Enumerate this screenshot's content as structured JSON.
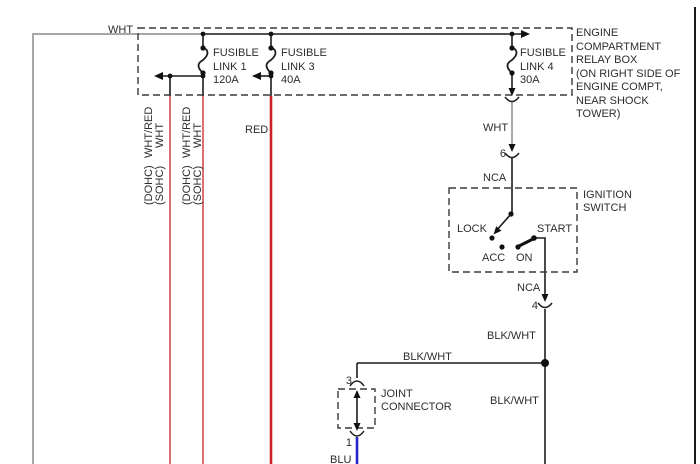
{
  "colors": {
    "wire_wht": "#a8a8a8",
    "wire_red_thin": "#cc3434",
    "wire_red_thick": "#cc2222",
    "wire_blu": "#2424cc",
    "wire_blk": "#1c1c1c",
    "text": "#2d2d2d"
  },
  "relay_box": {
    "label_lines": [
      "ENGINE",
      "COMPARTMENT",
      "RELAY BOX",
      "(ON RIGHT SIDE OF",
      "ENGINE COMPT,",
      "NEAR SHOCK",
      "TOWER)"
    ]
  },
  "fusible_links": [
    {
      "l1": "FUSIBLE",
      "l2": "LINK 1",
      "l3": "120A"
    },
    {
      "l1": "FUSIBLE",
      "l2": "LINK 3",
      "l3": "40A"
    },
    {
      "l1": "FUSIBLE",
      "l2": "LINK 4",
      "l3": "30A"
    }
  ],
  "branch_wires": [
    {
      "color_dohc": "WHT/RED",
      "color_sohc": "WHT",
      "engine_top": "(DOHC)",
      "engine_bottom": "(SOHC)"
    },
    {
      "color_dohc": "WHT/RED",
      "color_sohc": "WHT",
      "engine_top": "(DOHC)",
      "engine_bottom": "(SOHC)"
    }
  ],
  "ignition_switch": {
    "title_lines": [
      "IGNITION",
      "SWITCH"
    ],
    "positions": {
      "lock": "LOCK",
      "acc": "ACC",
      "on": "ON",
      "start": "START"
    }
  },
  "joint_connector": {
    "label_lines": [
      "JOINT",
      "CONNECTOR"
    ]
  },
  "connector_pins": {
    "c6": "6",
    "c4": "4",
    "c3": "3",
    "c1": "1"
  },
  "wire_labels": {
    "wht_top": "WHT",
    "red": "RED",
    "wht_mid": "WHT",
    "nca_upper": "NCA",
    "nca_lower": "NCA",
    "blkwht_vert_upper": "BLK/WHT",
    "blkwht_horiz": "BLK/WHT",
    "blkwht_vert_lower": "BLK/WHT",
    "blu": "BLU"
  }
}
